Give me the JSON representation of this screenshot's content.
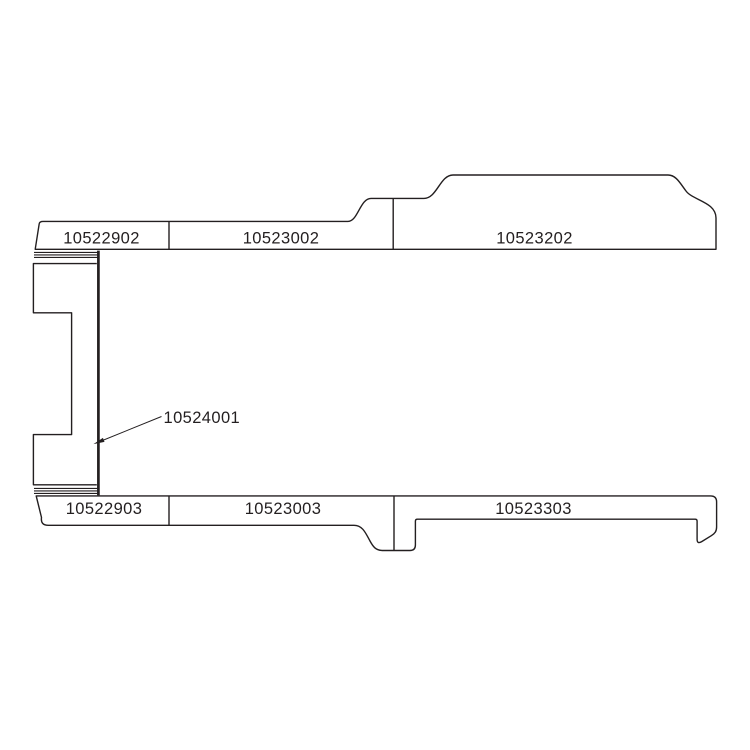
{
  "colors": {
    "background": "#ffffff",
    "line": "#231f20",
    "text": "#231f20"
  },
  "top_rail": {
    "segments": [
      {
        "part_number": "10522902"
      },
      {
        "part_number": "10523002"
      },
      {
        "part_number": "10523202"
      }
    ]
  },
  "bottom_rail": {
    "segments": [
      {
        "part_number": "10522903"
      },
      {
        "part_number": "10523003"
      },
      {
        "part_number": "10523303"
      }
    ]
  },
  "callout": {
    "part_number": "10524001"
  }
}
